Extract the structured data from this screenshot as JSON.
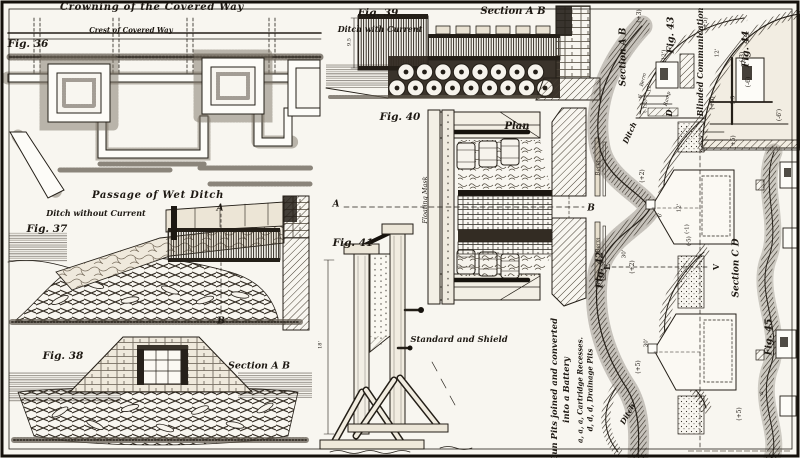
{
  "palette": {
    "paper": "#f8f6f0",
    "ink": "#241f18",
    "shade": "#6a6258"
  },
  "figures": [
    {
      "id": "fig-36",
      "labels": [
        {
          "t": "Crowning of the Covered Way",
          "x": 152,
          "y": 8,
          "s": 10,
          "b": 1,
          "i": 1,
          "sp": 1
        },
        {
          "t": "Fig. 36",
          "x": 28,
          "y": 44,
          "s": 10.5,
          "b": 1,
          "i": 1
        },
        {
          "t": "Crest of Covered Way",
          "x": 131,
          "y": 30,
          "s": 7,
          "b": 1,
          "i": 1
        }
      ]
    },
    {
      "id": "fig-37",
      "labels": [
        {
          "t": "Passage of Wet Ditch",
          "x": 158,
          "y": 196,
          "s": 10,
          "b": 1,
          "i": 1,
          "sp": 1
        },
        {
          "t": "Ditch without Current",
          "x": 96,
          "y": 213,
          "s": 8,
          "b": 1,
          "i": 1
        },
        {
          "t": "Fig. 37",
          "x": 47,
          "y": 229,
          "s": 10.5,
          "b": 1,
          "i": 1
        },
        {
          "t": "A",
          "x": 220,
          "y": 209,
          "s": 9,
          "b": 1,
          "i": 1
        },
        {
          "t": "B",
          "x": 221,
          "y": 322,
          "s": 9,
          "b": 1,
          "i": 1
        }
      ]
    },
    {
      "id": "fig-38",
      "labels": [
        {
          "t": "Fig. 38",
          "x": 63,
          "y": 356,
          "s": 10.5,
          "b": 1,
          "i": 1
        },
        {
          "t": "Section A B",
          "x": 259,
          "y": 366,
          "s": 9.5,
          "b": 1,
          "i": 1
        }
      ]
    },
    {
      "id": "fig-39",
      "labels": [
        {
          "t": "Fig. 39",
          "x": 378,
          "y": 13,
          "s": 10.5,
          "b": 1,
          "i": 1
        },
        {
          "t": "Ditch with Current",
          "x": 380,
          "y": 29,
          "s": 8,
          "b": 1,
          "i": 1
        },
        {
          "t": "Section A B",
          "x": 513,
          "y": 12,
          "s": 10,
          "b": 1,
          "i": 1
        },
        {
          "t": "9.5",
          "x": 350,
          "y": 42,
          "s": 5,
          "r": -90
        }
      ]
    },
    {
      "id": "fig-40",
      "labels": [
        {
          "t": "Fig. 40",
          "x": 400,
          "y": 117,
          "s": 10.5,
          "b": 1,
          "i": 1
        },
        {
          "t": "Plan",
          "x": 517,
          "y": 127,
          "s": 10,
          "b": 1,
          "i": 1
        },
        {
          "t": "A",
          "x": 336,
          "y": 205,
          "s": 9,
          "b": 1,
          "i": 1
        },
        {
          "t": "B",
          "x": 591,
          "y": 209,
          "s": 9,
          "b": 1,
          "i": 1
        },
        {
          "t": "Floating Mask",
          "x": 425,
          "y": 200,
          "s": 6.5,
          "i": 1,
          "r": -90
        },
        {
          "t": "Berm",
          "x": 599,
          "y": 168,
          "s": 5.5,
          "i": 1,
          "r": -90
        },
        {
          "t": "Berm",
          "x": 599,
          "y": 245,
          "s": 5.5,
          "i": 1,
          "r": -90
        }
      ]
    },
    {
      "id": "fig-41",
      "labels": [
        {
          "t": "Fig. 41",
          "x": 353,
          "y": 243,
          "s": 10.5,
          "b": 1,
          "i": 1
        },
        {
          "t": "Standard and Shield",
          "x": 459,
          "y": 340,
          "s": 8.5,
          "b": 1,
          "i": 1
        },
        {
          "t": "18'",
          "x": 321,
          "y": 345,
          "s": 5,
          "r": -90
        }
      ]
    },
    {
      "id": "fig-42",
      "labels": [
        {
          "t": "Fig. 42",
          "x": 600,
          "y": 270,
          "s": 9.5,
          "b": 1,
          "i": 1,
          "r": -90
        },
        {
          "t": "Ditch",
          "x": 630,
          "y": 133,
          "s": 7.5,
          "b": 1,
          "i": 1,
          "r": -65
        },
        {
          "t": "Ditch",
          "x": 628,
          "y": 414,
          "s": 7.5,
          "b": 1,
          "i": 1,
          "r": -60
        },
        {
          "t": "E",
          "x": 607,
          "y": 267,
          "s": 8,
          "b": 1,
          "r": -90
        },
        {
          "t": "V",
          "x": 716,
          "y": 267,
          "s": 8,
          "b": 1,
          "r": -90
        },
        {
          "t": "(+2)",
          "x": 633,
          "y": 267,
          "s": 6,
          "r": -90
        },
        {
          "t": "30'",
          "x": 625,
          "y": 254,
          "s": 5.5,
          "r": -90
        },
        {
          "t": "(+2)",
          "x": 643,
          "y": 176,
          "s": 6,
          "r": -90
        },
        {
          "t": "30'",
          "x": 647,
          "y": 343,
          "s": 5.5,
          "r": -90
        },
        {
          "t": "(+5)",
          "x": 639,
          "y": 367,
          "s": 6,
          "r": -90
        },
        {
          "t": "12'",
          "x": 680,
          "y": 208,
          "s": 5.5,
          "r": -90
        },
        {
          "t": "6'",
          "x": 661,
          "y": 215,
          "s": 5.5,
          "r": -90
        },
        {
          "t": "(-1)",
          "x": 688,
          "y": 229,
          "s": 5.5,
          "r": -90
        },
        {
          "t": "(-5)",
          "x": 690,
          "y": 241,
          "s": 5.5,
          "r": -90
        },
        {
          "t": "Gun Pits joined and converted",
          "x": 555,
          "y": 390,
          "s": 8.5,
          "b": 1,
          "i": 1,
          "r": -90
        },
        {
          "t": "into a Battery",
          "x": 567,
          "y": 390,
          "s": 8.5,
          "b": 1,
          "i": 1,
          "r": -90
        },
        {
          "t": "a, a, a, Cartridge Recesses.",
          "x": 580,
          "y": 390,
          "s": 7,
          "b": 1,
          "i": 1,
          "r": -90
        },
        {
          "t": "d, d, d, Drainage Pits",
          "x": 590,
          "y": 390,
          "s": 7,
          "b": 1,
          "i": 1,
          "r": -90
        }
      ]
    },
    {
      "id": "fig-43",
      "labels": [
        {
          "t": "Section A B",
          "x": 624,
          "y": 57,
          "s": 9,
          "b": 1,
          "i": 1,
          "r": -90
        },
        {
          "t": "Fig. 43",
          "x": 671,
          "y": 35,
          "s": 9.5,
          "b": 1,
          "i": 1,
          "r": -90
        },
        {
          "t": "(+3)",
          "x": 640,
          "y": 16,
          "s": 6,
          "r": -90
        },
        {
          "t": "(12')",
          "x": 665,
          "y": 56,
          "s": 5.5,
          "r": -90
        },
        {
          "t": "Berm",
          "x": 644,
          "y": 80,
          "s": 5,
          "i": 1,
          "r": -75
        },
        {
          "t": "Ramp",
          "x": 668,
          "y": 99,
          "s": 5,
          "i": 1,
          "r": -75
        },
        {
          "t": "12'",
          "x": 650,
          "y": 88,
          "s": 5,
          "r": -90
        },
        {
          "t": "6'",
          "x": 641,
          "y": 96,
          "s": 5,
          "r": -90
        },
        {
          "t": "(-1.5)",
          "x": 646,
          "y": 106,
          "s": 5,
          "r": -90
        },
        {
          "t": "D",
          "x": 669,
          "y": 113,
          "s": 8,
          "b": 1,
          "i": 1,
          "r": -90
        }
      ]
    },
    {
      "id": "fig-44",
      "labels": [
        {
          "t": "Blinded Communication",
          "x": 700,
          "y": 62,
          "s": 8,
          "b": 1,
          "i": 1,
          "r": -90
        },
        {
          "t": "Fig. 44",
          "x": 746,
          "y": 49,
          "s": 9.5,
          "b": 1,
          "i": 1,
          "r": -90
        },
        {
          "t": "(+5)",
          "x": 706,
          "y": 24,
          "s": 6,
          "r": -90
        },
        {
          "t": "(+5)",
          "x": 713,
          "y": 103,
          "s": 6,
          "r": -90
        },
        {
          "t": "12'",
          "x": 718,
          "y": 53,
          "s": 5.5,
          "r": -90
        },
        {
          "t": "(-3)",
          "x": 743,
          "y": 57,
          "s": 6,
          "r": -90
        },
        {
          "t": "(-6)",
          "x": 749,
          "y": 82,
          "s": 6,
          "r": -90
        },
        {
          "t": "5.5",
          "x": 734,
          "y": 100,
          "s": 5.5,
          "r": -90
        },
        {
          "t": "(-6')",
          "x": 780,
          "y": 115,
          "s": 6,
          "r": -90
        },
        {
          "t": "(+5)",
          "x": 734,
          "y": 142,
          "s": 6,
          "r": -90
        }
      ]
    },
    {
      "id": "fig-45-section-cd",
      "labels": [
        {
          "t": "Section C D",
          "x": 737,
          "y": 268,
          "s": 9,
          "b": 1,
          "i": 1,
          "r": -90
        },
        {
          "t": "Fig. 45",
          "x": 769,
          "y": 337,
          "s": 9.5,
          "b": 1,
          "i": 1,
          "r": -90
        },
        {
          "t": "(+5)",
          "x": 740,
          "y": 414,
          "s": 6,
          "r": -90
        },
        {
          "t": "a",
          "x": 762,
          "y": 393,
          "s": 6,
          "i": 1,
          "r": -90
        }
      ]
    }
  ]
}
